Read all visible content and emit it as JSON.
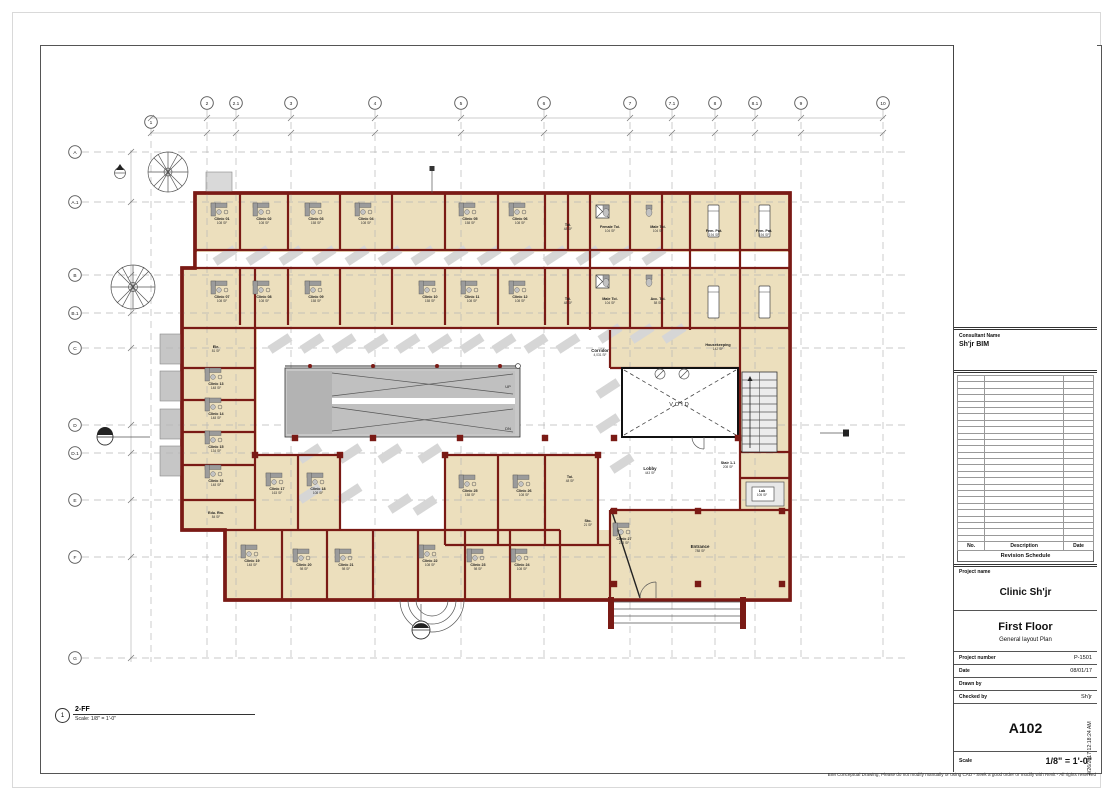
{
  "document": {
    "view_title": {
      "number": "1",
      "name": "2-FF",
      "scale": "Scale:  1/8\" = 1'-0\""
    },
    "disclaimer": "BIM Conceptual Drawing, Please do not modify manually or using CAD - Seek a good order or modify with Revit - All rights reserved"
  },
  "title_block": {
    "consultant_label": "Consultant Name",
    "consultant_name": "Sh'jr BIM",
    "revision_table": {
      "columns": [
        "No.",
        "Description",
        "Date"
      ],
      "caption": "Revision Schedule",
      "empty_rows": 26
    },
    "project_label": "Project name",
    "project_name": "Clinic Sh'jr",
    "sheet_name": "First Floor",
    "sheet_subtitle": "General layout Plan",
    "fields": [
      {
        "label": "Project number",
        "value": "P-1501"
      },
      {
        "label": "Date",
        "value": "08/01/17"
      },
      {
        "label": "Drawn by",
        "value": ""
      },
      {
        "label": "Checked by",
        "value": "Sh'jr"
      }
    ],
    "sheet_number": "A102",
    "scale_label": "Scale",
    "scale_value": "1/8\" = 1'-0\"",
    "print_timestamp": "4/26/2017 12:18:24 AM"
  },
  "plan": {
    "grid_columns": [
      {
        "label": "1",
        "x": 151,
        "y": 122
      },
      {
        "label": "2",
        "x": 207
      },
      {
        "label": "2.1",
        "x": 236
      },
      {
        "label": "3",
        "x": 291
      },
      {
        "label": "4",
        "x": 375
      },
      {
        "label": "5",
        "x": 461
      },
      {
        "label": "6",
        "x": 544
      },
      {
        "label": "7",
        "x": 630
      },
      {
        "label": "7.1",
        "x": 672
      },
      {
        "label": "8",
        "x": 715
      },
      {
        "label": "8.1",
        "x": 755
      },
      {
        "label": "9",
        "x": 801
      },
      {
        "label": "10",
        "x": 883
      }
    ],
    "grid_rows": [
      {
        "label": "A",
        "y": 152
      },
      {
        "label": "A.1",
        "y": 202
      },
      {
        "label": "B",
        "y": 275
      },
      {
        "label": "B.1",
        "y": 313
      },
      {
        "label": "C",
        "y": 348
      },
      {
        "label": "D",
        "y": 425
      },
      {
        "label": "D.1",
        "y": 453
      },
      {
        "label": "E",
        "y": 500
      },
      {
        "label": "F",
        "y": 557
      },
      {
        "label": "G",
        "y": 658
      }
    ],
    "rooms": [
      {
        "n": "Clinic 01",
        "a": "108 SF",
        "x": 222,
        "y": 220,
        "d": 1
      },
      {
        "n": "Clinic 02",
        "a": "108 SF",
        "x": 264,
        "y": 220,
        "d": 1
      },
      {
        "n": "Clinic 03",
        "a": "158 SF",
        "x": 316,
        "y": 220,
        "d": 1
      },
      {
        "n": "Clinic 04",
        "a": "108 SF",
        "x": 366,
        "y": 220,
        "d": 1
      },
      {
        "n": "Clinic 05",
        "a": "158 SF",
        "x": 470,
        "y": 220,
        "d": 1
      },
      {
        "n": "Clinic 06",
        "a": "108 SF",
        "x": 520,
        "y": 220,
        "d": 1
      },
      {
        "n": "Toi.",
        "a": "48 SF",
        "x": 568,
        "y": 226
      },
      {
        "n": "Female Toi.",
        "a": "104 SF",
        "x": 610,
        "y": 228
      },
      {
        "n": "Male Toi.",
        "a": "104 SF",
        "x": 658,
        "y": 228
      },
      {
        "n": "Fem. Pat.",
        "a": "194 SF",
        "x": 714,
        "y": 232
      },
      {
        "n": "Fem. Pat.",
        "a": "194 SF",
        "x": 764,
        "y": 232
      },
      {
        "n": "Clinic 07",
        "a": "108 SF",
        "x": 222,
        "y": 298,
        "d": 1
      },
      {
        "n": "Clinic 08",
        "a": "108 SF",
        "x": 264,
        "y": 298,
        "d": 1
      },
      {
        "n": "Clinic 09",
        "a": "158 SF",
        "x": 316,
        "y": 298,
        "d": 1
      },
      {
        "n": "Clinic 10",
        "a": "158 SF",
        "x": 430,
        "y": 298,
        "d": 1
      },
      {
        "n": "Clinic 11",
        "a": "108 SF",
        "x": 472,
        "y": 298,
        "d": 1
      },
      {
        "n": "Clinic 12",
        "a": "108 SF",
        "x": 520,
        "y": 298,
        "d": 1
      },
      {
        "n": "Toi.",
        "a": "48 SF",
        "x": 568,
        "y": 300
      },
      {
        "n": "Male Toi.",
        "a": "104 SF",
        "x": 610,
        "y": 300
      },
      {
        "n": "Acc. Toi.",
        "a": "58 SF",
        "x": 658,
        "y": 300
      },
      {
        "n": "Ele.",
        "a": "81 SF",
        "x": 216,
        "y": 348
      },
      {
        "n": "Clinic 13",
        "a": "148 SF",
        "x": 216,
        "y": 385,
        "d": 1
      },
      {
        "n": "Clinic 14",
        "a": "148 SF",
        "x": 216,
        "y": 415,
        "d": 1
      },
      {
        "n": "Clinic 15",
        "a": "134 SF",
        "x": 216,
        "y": 448,
        "d": 1
      },
      {
        "n": "Clinic 16",
        "a": "148 SF",
        "x": 216,
        "y": 482,
        "d": 1
      },
      {
        "n": "Edu. Rm.",
        "a": "84 SF",
        "x": 216,
        "y": 514
      },
      {
        "n": "Clinic 17",
        "a": "163 SF",
        "x": 277,
        "y": 490,
        "d": 1
      },
      {
        "n": "Clinic 18",
        "a": "108 SF",
        "x": 318,
        "y": 490,
        "d": 1
      },
      {
        "n": "Clinic 19",
        "a": "148 SF",
        "x": 252,
        "y": 562,
        "d": 1
      },
      {
        "n": "Clinic 20",
        "a": "98 SF",
        "x": 304,
        "y": 566,
        "d": 1
      },
      {
        "n": "Clinic 21",
        "a": "98 SF",
        "x": 346,
        "y": 566,
        "d": 1
      },
      {
        "n": "Clinic 22",
        "a": "108 SF",
        "x": 430,
        "y": 562,
        "d": 1
      },
      {
        "n": "Clinic 23",
        "a": "98 SF",
        "x": 478,
        "y": 566,
        "d": 1
      },
      {
        "n": "Clinic 24",
        "a": "108 SF",
        "x": 522,
        "y": 566,
        "d": 1
      },
      {
        "n": "Clinic 25",
        "a": "158 SF",
        "x": 470,
        "y": 492,
        "d": 1
      },
      {
        "n": "Clinic 26",
        "a": "108 SF",
        "x": 524,
        "y": 492,
        "d": 1
      },
      {
        "n": "Toi.",
        "a": "48 SF",
        "x": 570,
        "y": 478
      },
      {
        "n": "Sto.",
        "a": "21 SF",
        "x": 588,
        "y": 522
      },
      {
        "n": "Clinic 27",
        "a": "233 SF",
        "x": 624,
        "y": 540,
        "d": 1
      },
      {
        "n": "Entrance",
        "a": "788 SF",
        "x": 700,
        "y": 548,
        "s": "big"
      },
      {
        "n": "Corridor",
        "a": "4,031 SF",
        "x": 600,
        "y": 352,
        "s": "big"
      },
      {
        "n": "Housekeeping",
        "a": "142 SF",
        "x": 718,
        "y": 346
      },
      {
        "n": "Lobby",
        "a": "443 SF",
        "x": 650,
        "y": 470,
        "s": "big"
      },
      {
        "n": "Stair 1-1",
        "a": "208 SF",
        "x": 728,
        "y": 464
      },
      {
        "n": "Lab",
        "a": "105 SF",
        "x": 762,
        "y": 492
      },
      {
        "n": "VOID",
        "x": 680,
        "y": 406,
        "s": "void"
      },
      {
        "n": "UP",
        "x": 508,
        "y": 388,
        "s": "sm"
      },
      {
        "n": "DN",
        "x": 508,
        "y": 430,
        "s": "sm"
      }
    ],
    "shadows": [
      [
        215,
        262
      ],
      [
        248,
        262
      ],
      [
        281,
        262
      ],
      [
        314,
        262
      ],
      [
        347,
        262
      ],
      [
        380,
        262
      ],
      [
        413,
        262
      ],
      [
        446,
        262
      ],
      [
        479,
        262
      ],
      [
        512,
        262
      ],
      [
        545,
        262
      ],
      [
        578,
        262
      ],
      [
        611,
        262
      ],
      [
        644,
        262
      ],
      [
        270,
        350
      ],
      [
        302,
        350
      ],
      [
        334,
        350
      ],
      [
        366,
        350
      ],
      [
        398,
        350
      ],
      [
        430,
        350
      ],
      [
        462,
        350
      ],
      [
        494,
        350
      ],
      [
        526,
        350
      ],
      [
        558,
        350
      ],
      [
        300,
        460
      ],
      [
        340,
        460
      ],
      [
        380,
        460
      ],
      [
        420,
        460
      ],
      [
        300,
        500
      ],
      [
        340,
        500
      ],
      [
        390,
        510
      ],
      [
        415,
        512
      ],
      [
        600,
        340
      ],
      [
        632,
        340
      ],
      [
        664,
        340
      ],
      [
        612,
        470
      ],
      [
        598,
        430
      ],
      [
        598,
        395
      ]
    ],
    "columns_squares": [
      [
        295,
        438
      ],
      [
        373,
        438
      ],
      [
        460,
        438
      ],
      [
        545,
        438
      ],
      [
        614,
        438
      ],
      [
        738,
        438
      ],
      [
        614,
        511
      ],
      [
        698,
        511
      ],
      [
        782,
        511
      ],
      [
        614,
        584
      ],
      [
        698,
        584
      ],
      [
        782,
        584
      ],
      [
        255,
        455
      ],
      [
        340,
        455
      ],
      [
        445,
        455
      ],
      [
        598,
        455
      ]
    ],
    "beds": [
      [
        708,
        205
      ],
      [
        759,
        205
      ],
      [
        708,
        286
      ],
      [
        759,
        286
      ]
    ],
    "wcs": [
      [
        606,
        213
      ],
      [
        649,
        213
      ],
      [
        606,
        283
      ],
      [
        649,
        283
      ]
    ]
  },
  "colors": {
    "wall": "#7a1a15",
    "floor": "#ecdfbd",
    "shadow": "#d6d6d6",
    "fixture": "#9b9b9b",
    "grid": "#b7b7b7"
  }
}
